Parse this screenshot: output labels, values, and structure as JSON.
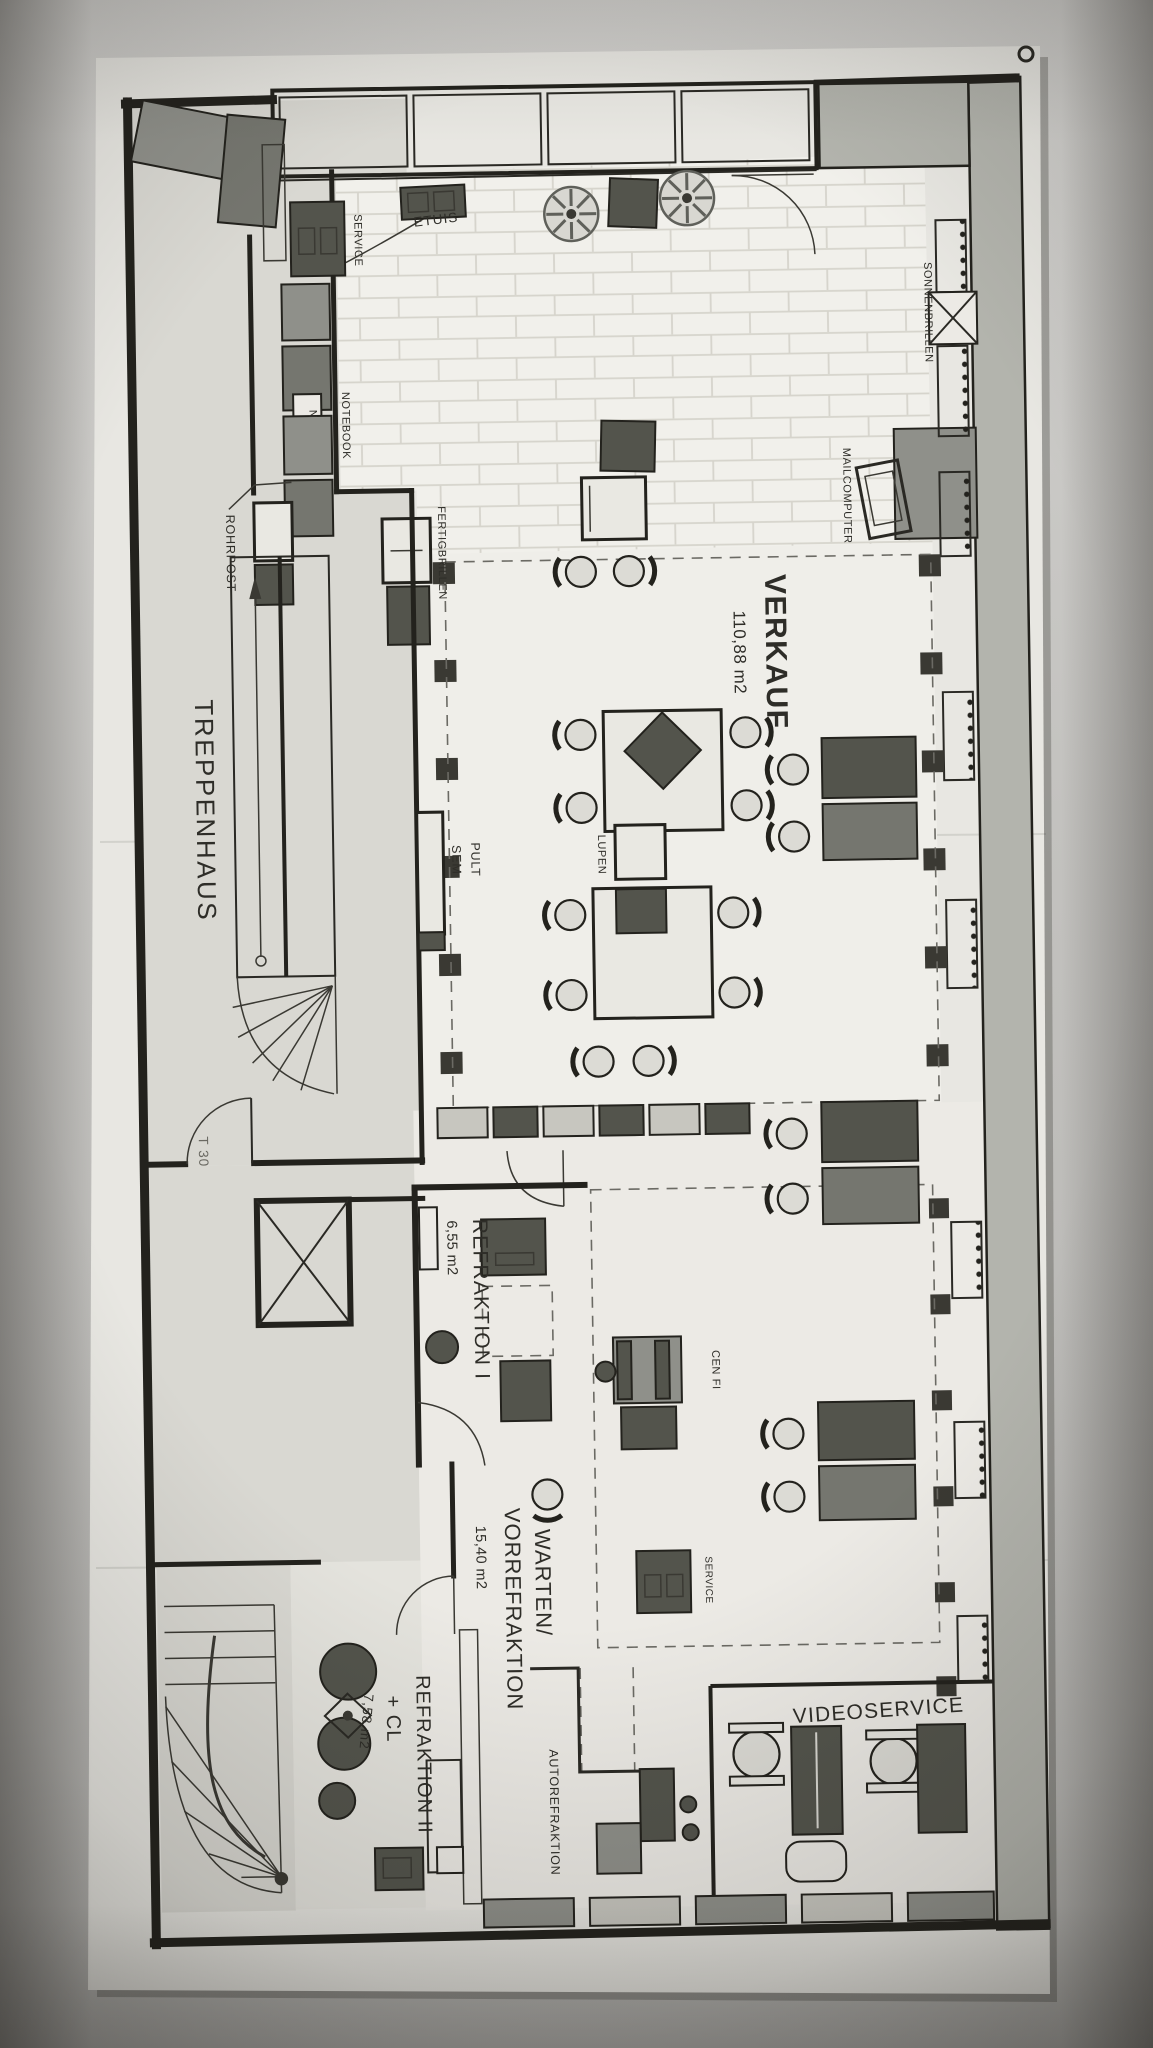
{
  "photo": {
    "description_colors": {
      "background": "#c3c2bf",
      "paper": "#e8e7e2"
    }
  },
  "plan": {
    "labels": {
      "treppenhaus": "TREPPENHAUS",
      "verkauf": "VERKAUF",
      "verkauf_area": "110,88 m2",
      "refraktion1": "REFRAKTION I",
      "refraktion1_area": "6,55 m2",
      "warten_line1": "WARTEN/",
      "warten_line2": "VORREFRAKTION",
      "warten_area": "15,40 m2",
      "refraktion2_line1": "REFRAKTION II",
      "refraktion2_line2": "+ CL",
      "refraktion2_area": "7,58 m2",
      "videoservice": "VIDEOSERVICE",
      "autorefraktion": "AUTOREFRAKTION",
      "service_front": "SERVICE",
      "service_mid": "SERVICE",
      "etuis": "ETUIS",
      "sonnenbrillen": "SONNENBRILLEN",
      "notebook": "NOTEBOOK",
      "notebook_box": "N",
      "rohrpost": "ROHRPOST",
      "mailcomputer": "MAILCOMPUTER",
      "fertigbrillen": "FERTIGBRILLEN",
      "sem": "SEM",
      "pult": "PULT",
      "lupen": "LUPEN",
      "cen_fi": "CEN FI",
      "door_t30": "T 30"
    },
    "colors": {
      "ink": "#23221d",
      "wall_gray": "#b3b4ad",
      "furniture_dark": "#53544c",
      "furniture_mid": "#8f908a",
      "floor_tile": "#f1f0eb",
      "paper": "#e8e7e2"
    }
  }
}
